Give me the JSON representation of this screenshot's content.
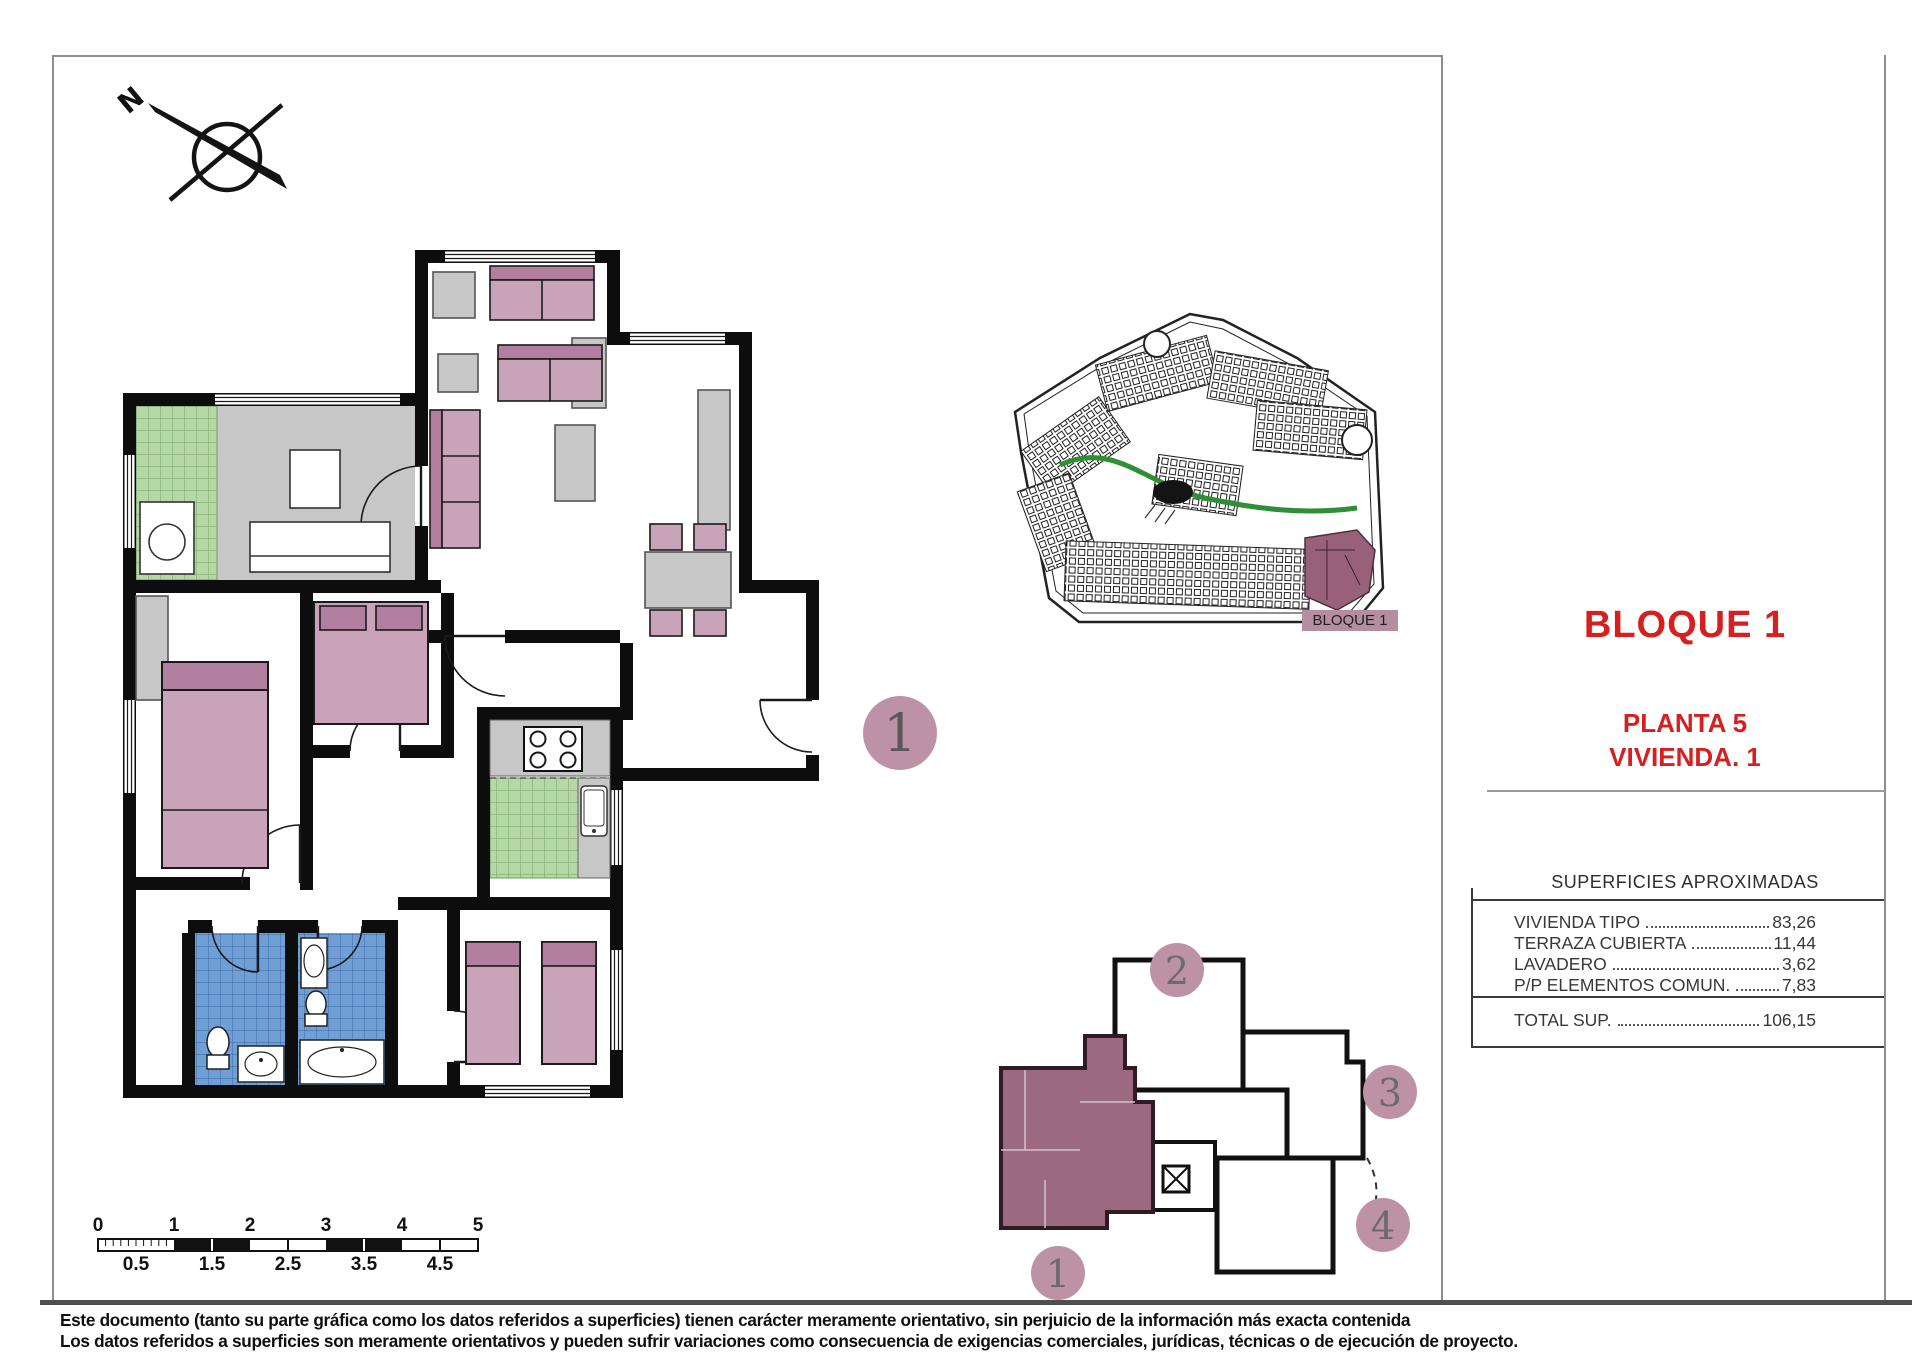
{
  "title_block": {
    "title": "BLOQUE 1",
    "planta": "PLANTA 5",
    "vivienda": "VIVIENDA. 1",
    "accent_color": "#d61f1f"
  },
  "surfaces": {
    "title": "SUPERFICIES APROXIMADAS",
    "rows": [
      {
        "label": "VIVIENDA TIPO",
        "value": "83,26"
      },
      {
        "label": "TERRAZA CUBIERTA",
        "value": "11,44"
      },
      {
        "label": "LAVADERO",
        "value": "3,62"
      },
      {
        "label": "P/P ELEMENTOS COMUN.",
        "value": "7,83"
      }
    ],
    "total_label": "TOTAL SUP.",
    "total_value": "106,15"
  },
  "site_plan": {
    "label": "BLOQUE 1",
    "highlight_color": "#99607a",
    "road_color": "#2f8f35"
  },
  "key_plan": {
    "circle_color": "#bd92a4",
    "unit_fill": "#9c6a80",
    "units": [
      {
        "number": "1",
        "highlighted": true
      },
      {
        "number": "2",
        "highlighted": false
      },
      {
        "number": "3",
        "highlighted": false
      },
      {
        "number": "4",
        "highlighted": false
      }
    ]
  },
  "unit_marker": {
    "number": "1"
  },
  "compass": {
    "north": "N"
  },
  "scale_bar": {
    "top_labels": [
      "0",
      "1",
      "2",
      "3",
      "4",
      "5"
    ],
    "bottom_labels": [
      "0.5",
      "1.5",
      "2.5",
      "3.5",
      "4.5"
    ]
  },
  "disclaimer": {
    "line1": "Este documento (tanto su parte gráfica como los datos referidos a superficies) tienen carácter meramente orientativo, sin perjuicio de la información más exacta contenida",
    "line2": "Los datos referidos a superficies son meramente orientativos y pueden sufrir variaciones como consecuencia de exigencias comerciales, jurídicas, técnicas o de ejecución de proyecto."
  },
  "colors": {
    "furniture_pink": "#c9a3b8",
    "furniture_pink_dark": "#b27fa0",
    "tile_green": "#b5d8a6",
    "tile_blue": "#6f9fd4",
    "floor_gray": "#c7c7c7",
    "wall": "#0d0d0d"
  }
}
